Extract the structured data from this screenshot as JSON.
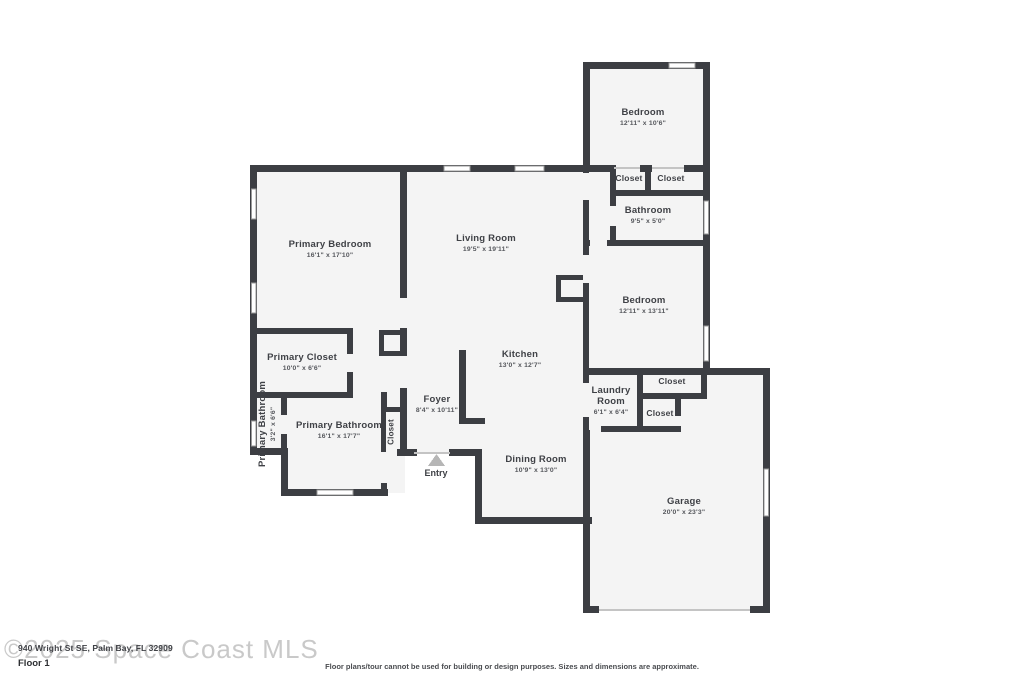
{
  "floor_label": "Floor 1",
  "watermark": "©2025 Space Coast MLS",
  "address_overlay": "940 Wright St SE, Palm Bay, FL 32909",
  "disclaimer": "Floor plans/tour cannot be used for building or design purposes. Sizes and dimensions are approximate.",
  "entry": {
    "label": "Entry"
  },
  "colors": {
    "wall": "#3c3e43",
    "room_fill": "#f4f4f4",
    "label": "#3f4146",
    "dims": "#55575c",
    "watermark": "#c9c9c9"
  },
  "rooms": {
    "bedroom_top": {
      "name": "Bedroom",
      "dims": "12'11\" x 10'6\""
    },
    "closet_top_1": {
      "name": "Closet"
    },
    "closet_top_2": {
      "name": "Closet"
    },
    "bathroom": {
      "name": "Bathroom",
      "dims": "9'5\" x 5'0\""
    },
    "bedroom_right": {
      "name": "Bedroom",
      "dims": "12'11\" x 13'11\""
    },
    "primary_bedroom": {
      "name": "Primary Bedroom",
      "dims": "16'1\" x 17'10\""
    },
    "living_room": {
      "name": "Living Room",
      "dims": "19'5\" x 19'11\""
    },
    "kitchen": {
      "name": "Kitchen",
      "dims": "13'0\" x 12'7\""
    },
    "primary_closet": {
      "name": "Primary Closet",
      "dims": "10'0\" x 6'6\""
    },
    "primary_bathroom_small": {
      "name": "Primary Bathroom",
      "dims": "3'2\" x 6'6\""
    },
    "primary_bathroom": {
      "name": "Primary Bathroom",
      "dims": "16'1\" x 17'7\""
    },
    "closet_hall": {
      "name": "Closet"
    },
    "foyer": {
      "name": "Foyer",
      "dims": "8'4\" x 10'11\""
    },
    "dining_room": {
      "name": "Dining Room",
      "dims": "10'9\" x 13'0\""
    },
    "laundry_room": {
      "name": "Laundry Room",
      "dims": "6'1\" x 6'4\""
    },
    "closet_laundry_1": {
      "name": "Closet"
    },
    "closet_laundry_2": {
      "name": "Closet"
    },
    "garage": {
      "name": "Garage",
      "dims": "20'0\" x 23'3\""
    }
  }
}
